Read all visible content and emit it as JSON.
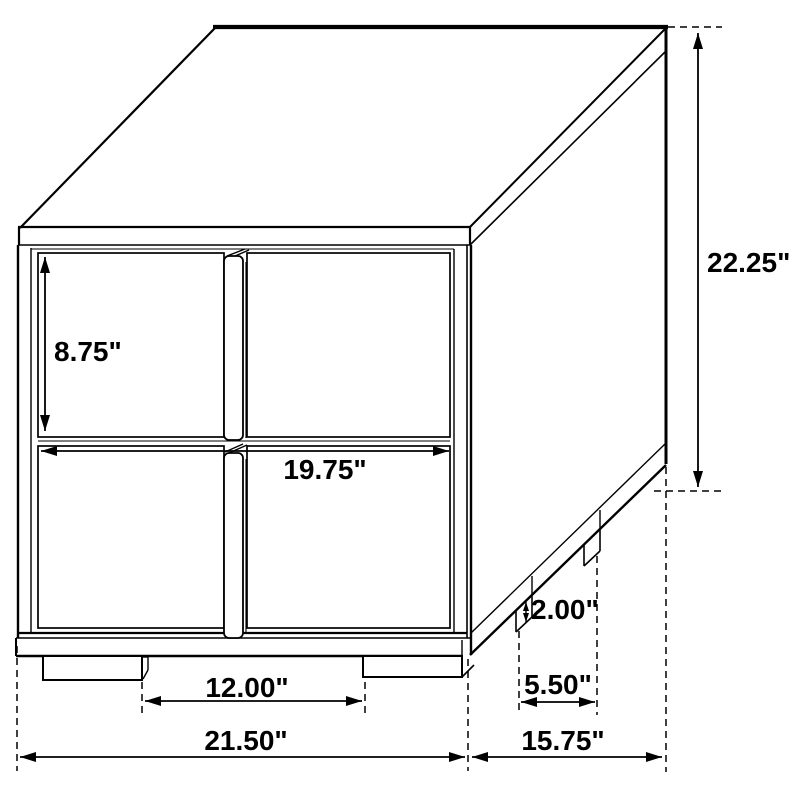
{
  "figure": {
    "subject": "two-drawer nightstand dimension line drawing",
    "background_color": "#ffffff",
    "line_color": "#000000"
  },
  "dimensions": {
    "overall_height": "22.25\"",
    "drawer_front_height": "8.75\"",
    "drawer_width": "19.75\"",
    "leg_height": "2.00\"",
    "front_leg_spacing": "12.00\"",
    "side_leg_spacing": "5.50\"",
    "overall_width": "21.50\"",
    "overall_depth": "15.75\""
  }
}
